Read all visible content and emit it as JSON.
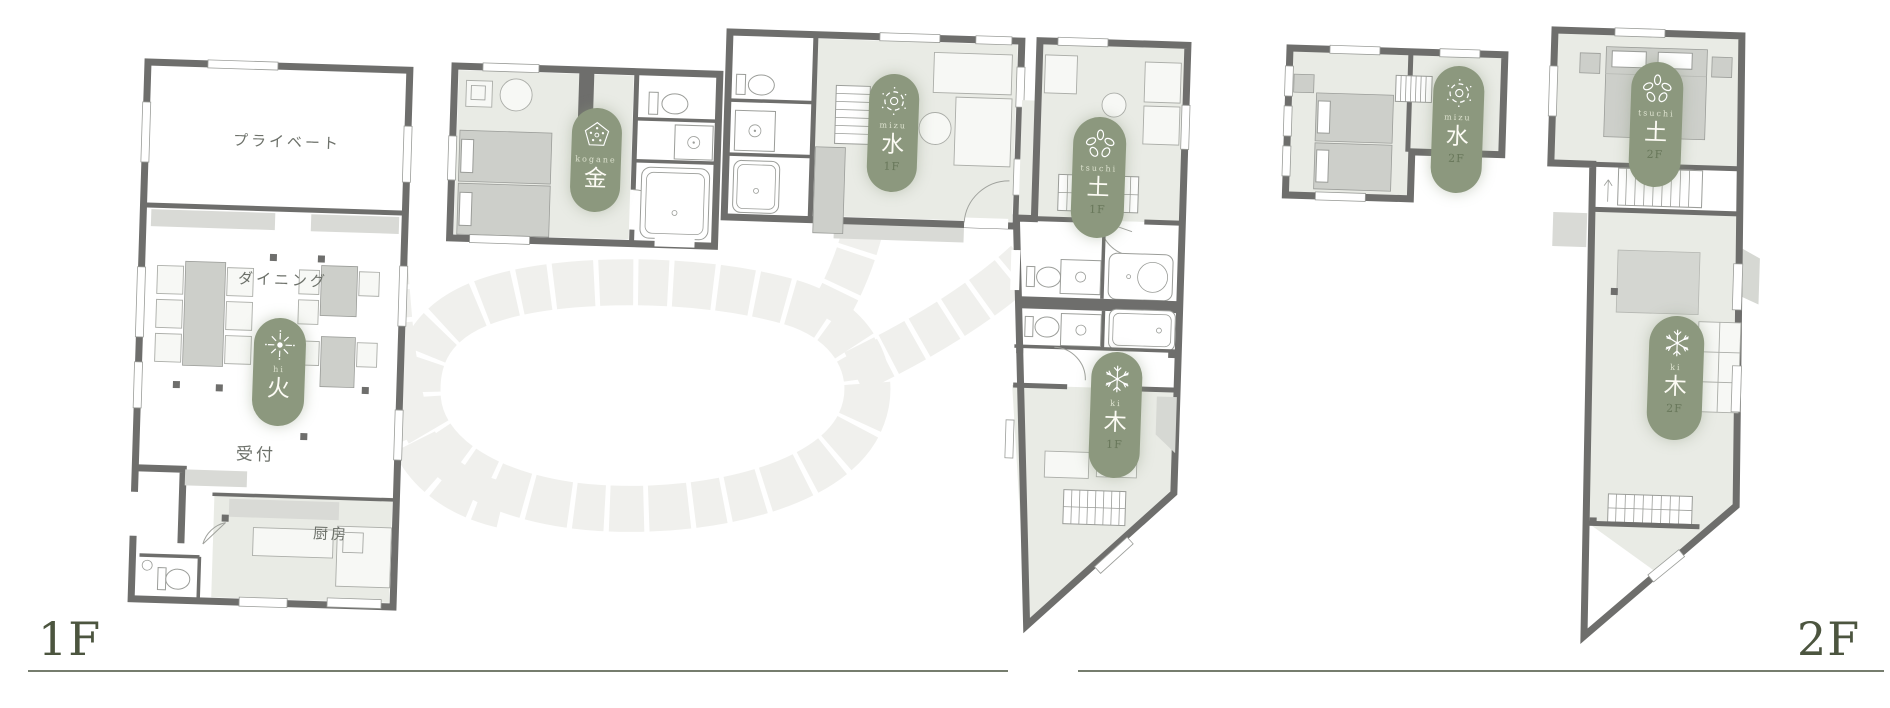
{
  "floors": {
    "f1": {
      "label": "1F"
    },
    "f2": {
      "label": "2F"
    }
  },
  "rooms": {
    "private": "プライベート",
    "dining": "ダイニング",
    "reception": "受付",
    "kitchen": "厨房"
  },
  "badges": [
    {
      "name": "hi-1f",
      "roman": "hi",
      "kanji": "火",
      "floor": "",
      "icon": "fire-icon"
    },
    {
      "name": "kogane-1f",
      "roman": "kogane",
      "kanji": "金",
      "floor": "",
      "icon": "gold-icon"
    },
    {
      "name": "mizu-1f",
      "roman": "mizu",
      "kanji": "水",
      "floor": "1F",
      "icon": "water-icon"
    },
    {
      "name": "tsuchi-1f",
      "roman": "tsuchi",
      "kanji": "土",
      "floor": "1F",
      "icon": "earth-icon"
    },
    {
      "name": "ki-1f",
      "roman": "ki",
      "kanji": "木",
      "floor": "1F",
      "icon": "tree-icon"
    },
    {
      "name": "mizu-2f",
      "roman": "mizu",
      "kanji": "水",
      "floor": "2F",
      "icon": "water-icon"
    },
    {
      "name": "tsuchi-2f",
      "roman": "tsuchi",
      "kanji": "土",
      "floor": "2F",
      "icon": "earth-icon"
    },
    {
      "name": "ki-2f",
      "roman": "ki",
      "kanji": "木",
      "floor": "2F",
      "icon": "tree-icon"
    }
  ],
  "colors": {
    "badge_green": "#8c987e",
    "wall_gray": "#6e6e6c",
    "floor_tint": "#e9ebe5",
    "stone_path": "#f0f0ed",
    "floor_label_green": "#4c553f"
  }
}
